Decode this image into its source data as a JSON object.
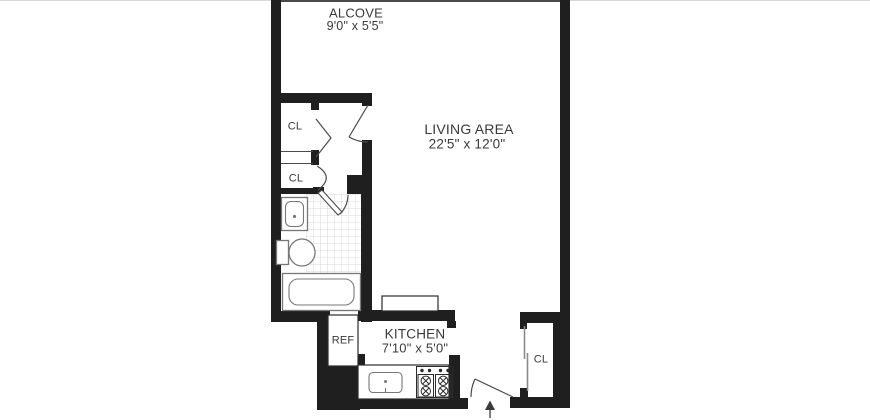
{
  "rooms": {
    "alcove": {
      "name": "ALCOVE",
      "dims": "9'0\" x 5'5\""
    },
    "living_area": {
      "name": "LIVING AREA",
      "dims": "22'5\" x 12'0\""
    },
    "kitchen": {
      "name": "KITCHEN",
      "dims": "7'10\" x 5'0\""
    }
  },
  "labels": {
    "closet_1": "CL",
    "closet_2": "CL",
    "entry_closet": "CL",
    "refrigerator": "REF"
  },
  "icons": {
    "entrance_arrow": "arrow-up"
  },
  "colors": {
    "wall": "#1f1f1f",
    "sliver": "#4a4a4a",
    "hairline": "#d9d9d9",
    "door_line": "#4a4a4a",
    "slide_line": "#8a8a8a",
    "fixture_line": "#777777",
    "counter_line": "#2b2b2b",
    "tile_line": "#d8d8d8",
    "text": "#3a3a3a",
    "background": "#ffffff"
  }
}
